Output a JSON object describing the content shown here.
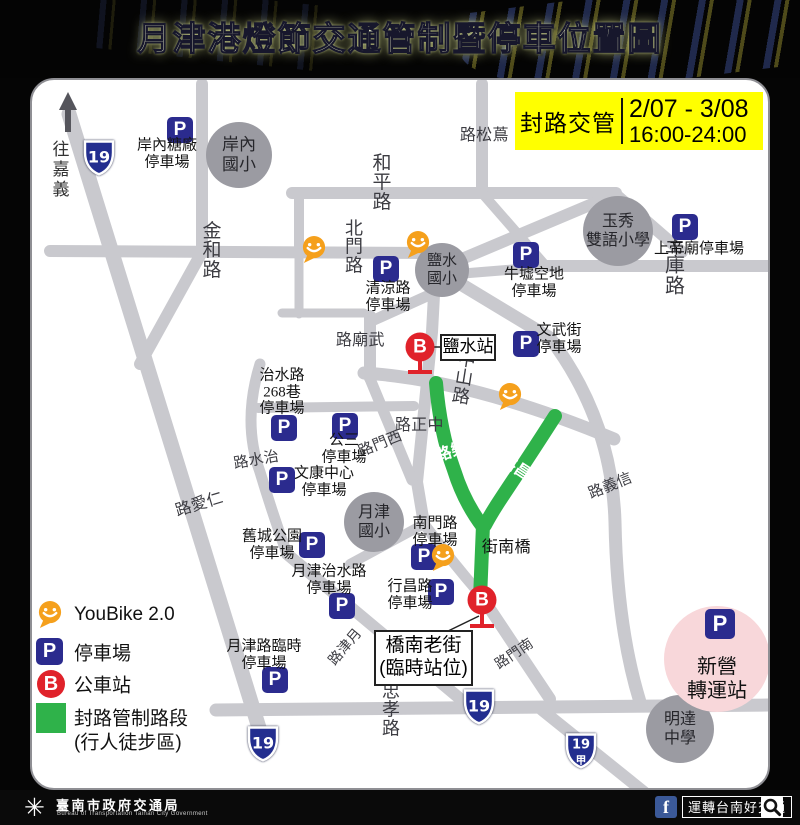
{
  "title": "月津港燈節交通管制暨停車位置圖",
  "notice": {
    "label": "封路交管",
    "line1": "2/07 - 3/08",
    "line2": "16:00-24:00"
  },
  "compass": {
    "dest": "往嘉義"
  },
  "glyphs": {
    "parking": "P",
    "bus": "B",
    "logo": "✳",
    "fb": "f"
  },
  "colors": {
    "road": "#c9c9ce",
    "closed_road": "#2fb24a",
    "parking": "#2b2b8e",
    "bus": "#e0222a",
    "youbike": "#f5a01c",
    "notice_bg": "#ffff00",
    "hub_bg": "#f8d7da",
    "school": "#9b9ba2"
  },
  "legend": {
    "youbike": "YouBike 2.0",
    "parking": "停車場",
    "bus": "公車站",
    "closed1": "封路管制路段",
    "closed2": "(行人徒步區)"
  },
  "footer": {
    "agency": "臺南市政府交通局",
    "agency_en": "Bureau of Transportation Tainan City Government",
    "fb": "運轉台南好交通"
  },
  "map": {
    "road_labels": [
      {
        "text": "金和路",
        "x": 180,
        "y": 171,
        "fs": 19
      },
      {
        "text": "和平路",
        "x": 350,
        "y": 103,
        "fs": 19
      },
      {
        "text": "北門路",
        "x": 322,
        "y": 167,
        "fs": 18
      },
      {
        "text": "土庫路",
        "x": 643,
        "y": 186,
        "fs": 20
      },
      {
        "text": "忠孝路",
        "x": 359,
        "y": 630,
        "fs": 18
      },
      {
        "text": "蔦松路",
        "x": 449,
        "y": 55,
        "fs": 16,
        "vert": true
      },
      {
        "text": "武廟路",
        "x": 325,
        "y": 260,
        "fs": 16,
        "vert": true
      },
      {
        "text": "中正路",
        "x": 384,
        "y": 345,
        "fs": 16,
        "vert": true
      },
      {
        "text": "橋南街",
        "x": 471,
        "y": 467,
        "fs": 16,
        "vert": true,
        "color": "#111"
      },
      {
        "text": "中山路",
        "x": 432,
        "y": 298,
        "fs": 18,
        "rot": 9
      },
      {
        "text": "西門路",
        "x": 347,
        "y": 364,
        "fs": 15,
        "vert": true,
        "rot": -22
      },
      {
        "text": "治水路",
        "x": 223,
        "y": 380,
        "fs": 15,
        "vert": true,
        "rot": -10
      },
      {
        "text": "仁愛路",
        "x": 164,
        "y": 425,
        "fs": 16,
        "vert": true,
        "rot": -17
      },
      {
        "text": "信義路",
        "x": 577,
        "y": 406,
        "fs": 15,
        "vert": true,
        "rot": -22
      },
      {
        "text": "南門路",
        "x": 482,
        "y": 574,
        "fs": 14,
        "vert": true,
        "rot": -34
      },
      {
        "text": "月津路",
        "x": 313,
        "y": 567,
        "fs": 14,
        "vert": true,
        "rot": -50
      },
      {
        "text": "康樂路",
        "x": 424,
        "y": 370,
        "fs": 16,
        "vert": true,
        "rot": -18,
        "white": true
      },
      {
        "text": "行昌路",
        "x": 488,
        "y": 390,
        "fs": 16,
        "vert": true,
        "rot": 33,
        "white": true
      }
    ],
    "parkings": [
      {
        "x": 148,
        "y": 50,
        "lines": [
          "岸內糖廠",
          "停車場"
        ],
        "lx": 135,
        "ly": 74
      },
      {
        "x": 354,
        "y": 189,
        "lines": [
          "清涼路",
          "停車場"
        ],
        "lx": 356,
        "ly": 217
      },
      {
        "x": 494,
        "y": 175,
        "lines": [
          "牛墟空地",
          "停車場"
        ],
        "lx": 502,
        "ly": 203
      },
      {
        "x": 653,
        "y": 147,
        "lines": [
          "上帝廟停車場"
        ],
        "lx": 667,
        "ly": 169
      },
      {
        "x": 494,
        "y": 264,
        "lines": [
          "文武街",
          "停車場"
        ],
        "lx": 527,
        "ly": 259
      },
      {
        "x": 252,
        "y": 348,
        "lines": [
          "治水路",
          "268巷",
          "停車場"
        ],
        "lx": 250,
        "ly": 312
      },
      {
        "x": 313,
        "y": 346,
        "lines": [
          "公三",
          "停車場"
        ],
        "lx": 312,
        "ly": 369
      },
      {
        "x": 250,
        "y": 400,
        "lines": [
          "文康中心",
          "停車場"
        ],
        "lx": 292,
        "ly": 402
      },
      {
        "x": 280,
        "y": 465,
        "lines": [
          "舊城公園",
          "停車場"
        ],
        "lx": 240,
        "ly": 465
      },
      {
        "x": 310,
        "y": 526,
        "lines": [
          "月津治水路",
          "停車場"
        ],
        "lx": 297,
        "ly": 500
      },
      {
        "x": 243,
        "y": 600,
        "lines": [
          "月津路臨時",
          "停車場"
        ],
        "lx": 232,
        "ly": 575
      },
      {
        "x": 392,
        "y": 477,
        "lines": [
          "南門路",
          "停車場"
        ],
        "lx": 403,
        "ly": 452
      },
      {
        "x": 409,
        "y": 512,
        "lines": [
          "行昌路",
          "停車場"
        ],
        "lx": 378,
        "ly": 515
      }
    ],
    "youbikes": [
      {
        "x": 282,
        "y": 171
      },
      {
        "x": 386,
        "y": 166
      },
      {
        "x": 478,
        "y": 318
      },
      {
        "x": 411,
        "y": 479
      }
    ],
    "schools": [
      {
        "x": 207,
        "y": 75,
        "r": 33,
        "lines": [
          "岸內",
          "國小"
        ],
        "fs": 17
      },
      {
        "x": 410,
        "y": 190,
        "r": 27,
        "lines": [
          "鹽水",
          "國小"
        ],
        "fs": 15
      },
      {
        "x": 586,
        "y": 151,
        "r": 35,
        "lines": [
          "玉秀",
          "雙語小學"
        ],
        "fs": 16
      },
      {
        "x": 342,
        "y": 442,
        "r": 30,
        "lines": [
          "月津",
          "國小"
        ],
        "fs": 16
      },
      {
        "x": 648,
        "y": 649,
        "r": 34,
        "lines": [
          "明達",
          "中學"
        ],
        "fs": 16
      }
    ],
    "bus_stops": [
      {
        "x": 388,
        "y": 267,
        "box": {
          "x": 408,
          "y": 254,
          "w": 56,
          "h": 27,
          "fs": 17,
          "lines": [
            "鹽水站"
          ]
        }
      },
      {
        "x": 450,
        "y": 520,
        "box": {
          "x": 342,
          "y": 550,
          "w": 99,
          "h": 56,
          "fs": 19,
          "lines": [
            "橋南老街",
            "(臨時站位)"
          ]
        }
      }
    ],
    "shields": [
      {
        "x": 67,
        "y": 80,
        "label": "19"
      },
      {
        "x": 231,
        "y": 666,
        "label": "19"
      },
      {
        "x": 447,
        "y": 629,
        "label": "19"
      },
      {
        "x": 549,
        "y": 673,
        "label": "19",
        "sub": "甲"
      }
    ],
    "hub": {
      "line1": "新營",
      "line2": "轉運站"
    }
  }
}
